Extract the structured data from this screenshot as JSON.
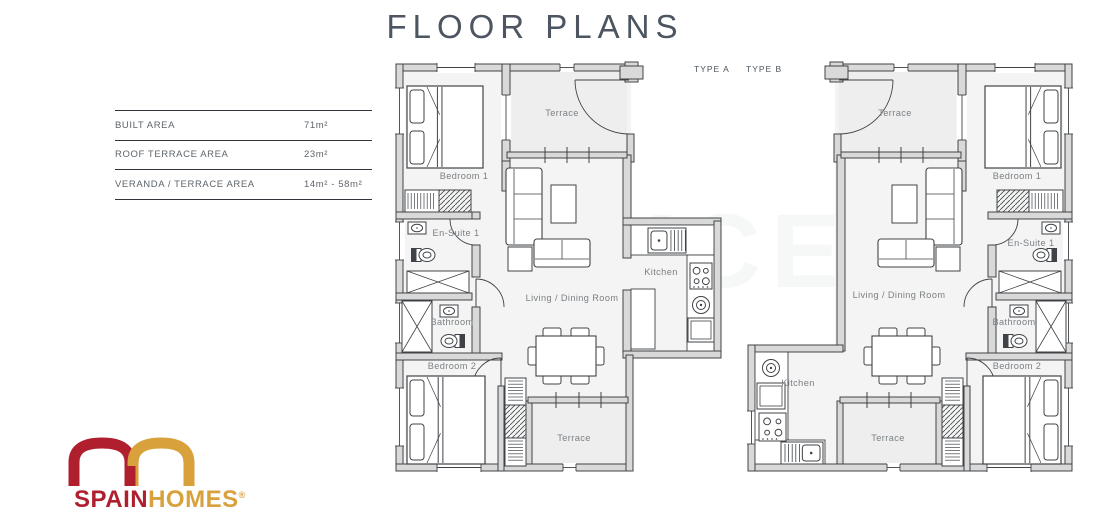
{
  "page": {
    "title": "FLOOR PLANS"
  },
  "tabs": [
    {
      "label": "TYPE A"
    },
    {
      "label": "TYPE B"
    }
  ],
  "specs": {
    "rows": [
      {
        "label": "BUILT AREA",
        "value": "71m²"
      },
      {
        "label": "ROOF TERRACE AREA",
        "value": "23m²"
      },
      {
        "label": "VERANDA / TERRACE AREA",
        "value": "14m² - 58m²"
      }
    ]
  },
  "logo": {
    "brand_red": "SPAIN",
    "brand_gold": "HOMES",
    "registered": "®"
  },
  "watermark": "TEKCE",
  "colors": {
    "wall": "#d9d9d9",
    "line": "#3f4347",
    "floor": "#f4f4f4",
    "terrace_floor": "#eeeeee",
    "label": "#7b8084",
    "title": "#4c5560",
    "brand_red": "#b01f2e",
    "brand_gold": "#d8a13c"
  },
  "plans": [
    {
      "id": "type-a",
      "rooms": [
        {
          "key": "bedroom-1",
          "label": "Bedroom 1"
        },
        {
          "key": "terrace-top",
          "label": "Terrace"
        },
        {
          "key": "en-suite-1",
          "label": "En-Suite 1"
        },
        {
          "key": "bathroom",
          "label": "Bathroom"
        },
        {
          "key": "bedroom-2",
          "label": "Bedroom 2"
        },
        {
          "key": "living-dining",
          "label": "Living / Dining Room"
        },
        {
          "key": "kitchen",
          "label": "Kitchen"
        },
        {
          "key": "terrace-bottom",
          "label": "Terrace"
        }
      ]
    },
    {
      "id": "type-b",
      "rooms": [
        {
          "key": "bedroom-1",
          "label": "Bedroom 1"
        },
        {
          "key": "terrace-top",
          "label": "Terrace"
        },
        {
          "key": "en-suite-1",
          "label": "En-Suite 1"
        },
        {
          "key": "bathroom",
          "label": "Bathroom"
        },
        {
          "key": "bedroom-2",
          "label": "Bedroom 2"
        },
        {
          "key": "living-dining",
          "label": "Living / Dining Room"
        },
        {
          "key": "kitchen",
          "label": "Kitchen"
        },
        {
          "key": "terrace-bottom",
          "label": "Terrace"
        }
      ]
    }
  ]
}
